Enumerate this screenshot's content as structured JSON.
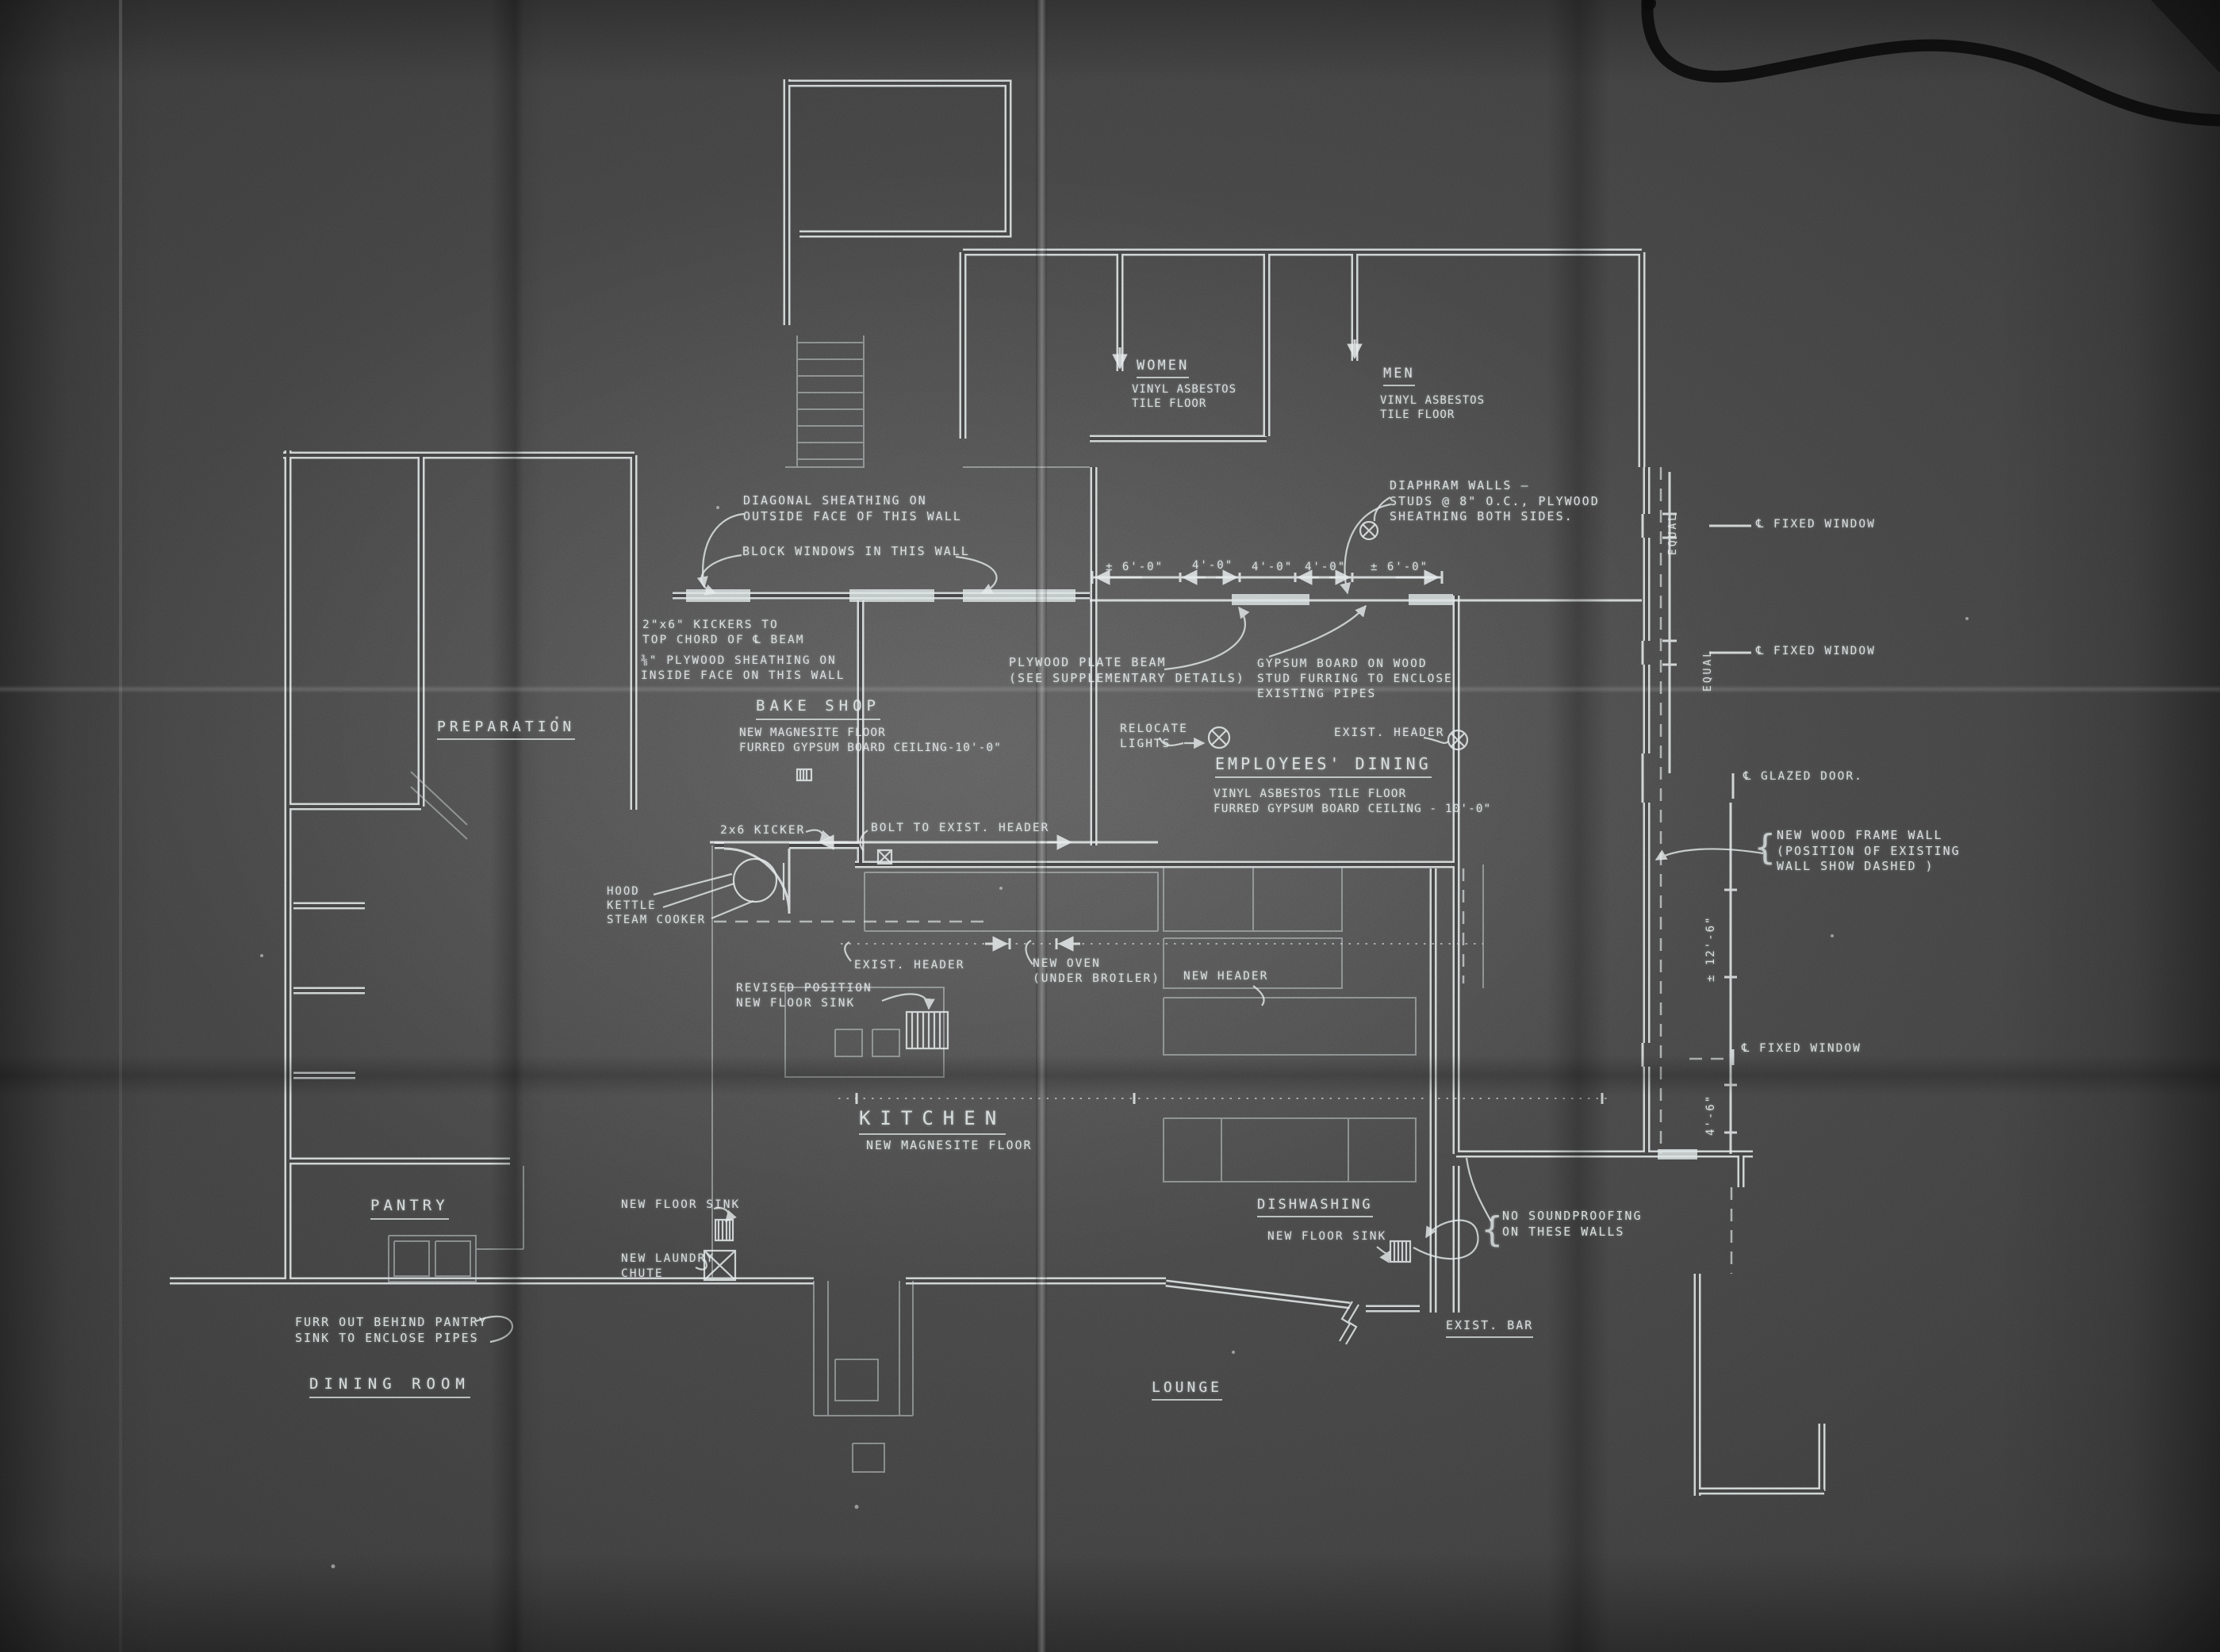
{
  "style": {
    "paper_color": "#4a4a4a",
    "ink_color": "#e3e9e9"
  },
  "rooms": {
    "women": {
      "title": "WOMEN",
      "floor": "VINYL ASBESTOS\nTILE FLOOR"
    },
    "men": {
      "title": "MEN",
      "floor": "VINYL ASBESTOS\nTILE FLOOR"
    },
    "preparation": {
      "title": "PREPARATION"
    },
    "bake_shop": {
      "title": "BAKE SHOP",
      "floor": "NEW MAGNESITE FLOOR\nFURRED GYPSUM BOARD CEILING-10'-0\""
    },
    "employees_dining": {
      "title": "EMPLOYEES' DINING",
      "floor": "VINYL ASBESTOS TILE FLOOR\nFURRED GYPSUM BOARD CEILING - 10'-0\""
    },
    "kitchen": {
      "title": "KITCHEN",
      "floor": "NEW MAGNESITE FLOOR"
    },
    "pantry": {
      "title": "PANTRY"
    },
    "dishwashing": {
      "title": "DISHWASHING"
    },
    "dining_room": {
      "title": "DINING ROOM"
    },
    "lounge": {
      "title": "LOUNGE"
    },
    "exist_bar": {
      "title": "EXIST. BAR"
    }
  },
  "notes": {
    "diagonal_sheathing": "DIAGONAL SHEATHING ON\nOUTSIDE FACE OF THIS WALL",
    "block_windows": "BLOCK WINDOWS IN THIS WALL",
    "diaphram_walls": "DIAPHRAM WALLS —\nSTUDS @ 8\" O.C., PLYWOOD\nSHEATHING BOTH SIDES.",
    "kickers": "2\"x6\" KICKERS TO\nTOP CHORD OF ℄ BEAM",
    "plywood_sheathing": "⅜\" PLYWOOD SHEATHING ON\nINSIDE FACE ON THIS WALL",
    "plate_beam": "PLYWOOD PLATE BEAM\n(SEE SUPPLEMENTARY DETAILS)",
    "gypsum_board": "GYPSUM BOARD ON WOOD\nSTUD FURRING TO ENCLOSE\nEXISTING PIPES",
    "relocate_lights": "RELOCATE\nLIGHTS",
    "exist_header": "EXIST. HEADER",
    "new_wood_frame_wall": "NEW WOOD FRAME WALL\n(POSITION OF EXISTING\nWALL SHOW DASHED )",
    "kicker": "2x6 KICKER",
    "bolt_header": "BOLT TO EXIST. HEADER",
    "hood_kettle": "HOOD\nKETTLE\nSTEAM COOKER",
    "new_oven": "NEW OVEN\n(UNDER BROILER)",
    "new_header": "NEW HEADER",
    "revised_sink": "REVISED POSITION\nNEW FLOOR SINK",
    "new_floor_sink": "NEW FLOOR SINK",
    "laundry_chute": "NEW LAUNDRY\nCHUTE",
    "no_soundproofing": "NO SOUNDPROOFING\nON THESE WALLS",
    "furr_out": "FURR OUT BEHIND PANTRY\nSINK TO ENCLOSE PIPES",
    "brace": "{"
  },
  "dims": {
    "top": [
      "± 6'-0\"",
      "4'-0\"",
      "4'-0\"",
      "4'-0\"",
      "± 6'-0\""
    ],
    "equal": "EQUAL",
    "tall": "± 12'-6\"",
    "short": "4'-6\"",
    "fixed_window": "℄ FIXED WINDOW",
    "glazed_door": "℄ GLAZED DOOR."
  }
}
